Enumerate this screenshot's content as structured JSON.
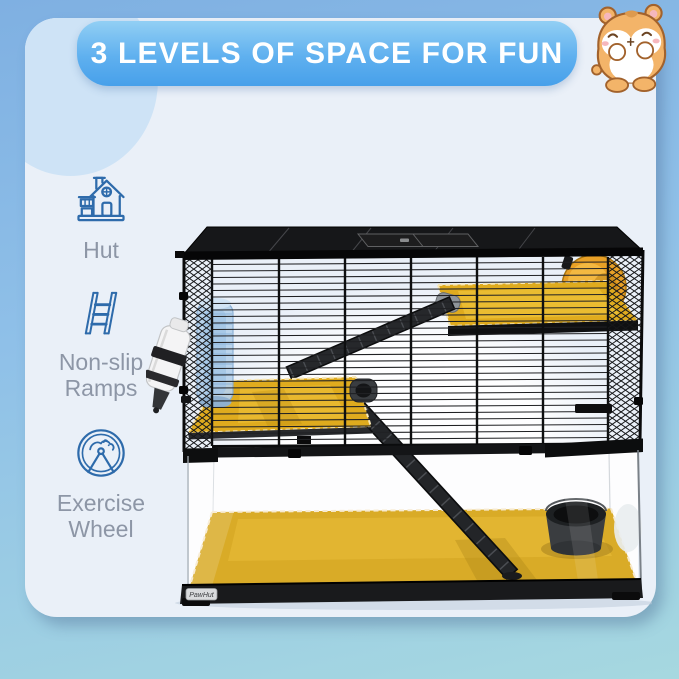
{
  "header": {
    "title": "3 LEVELS OF SPACE FOR FUN"
  },
  "features": [
    {
      "icon": "hut-icon",
      "label": "Hut"
    },
    {
      "icon": "ladder-icon",
      "label": "Non-slip Ramps"
    },
    {
      "icon": "exercise-wheel-icon",
      "label": "Exercise Wheel"
    }
  ],
  "product": {
    "brand_label": "PawHut",
    "photo_alt": "Three-level hamster cage with black wire top, glass tank base, two yellow platforms, black non-slip ramps, orange exercise wheel, water bottles and food bowl"
  },
  "mascot": {
    "alt": "Cartoon hamster illustration"
  },
  "colors": {
    "background_top": "#7fb0e2",
    "background_bottom": "#a6d8e0",
    "card": "#eaf0f8",
    "banner_top": "#92cff4",
    "banner_bottom": "#47a0ea",
    "title_text": "#ffffff",
    "icon_blue": "#2e6bab",
    "label_gray": "#8d96a6",
    "platform_yellow": "#dfab1e",
    "wheel_orange": "#e8a026"
  }
}
